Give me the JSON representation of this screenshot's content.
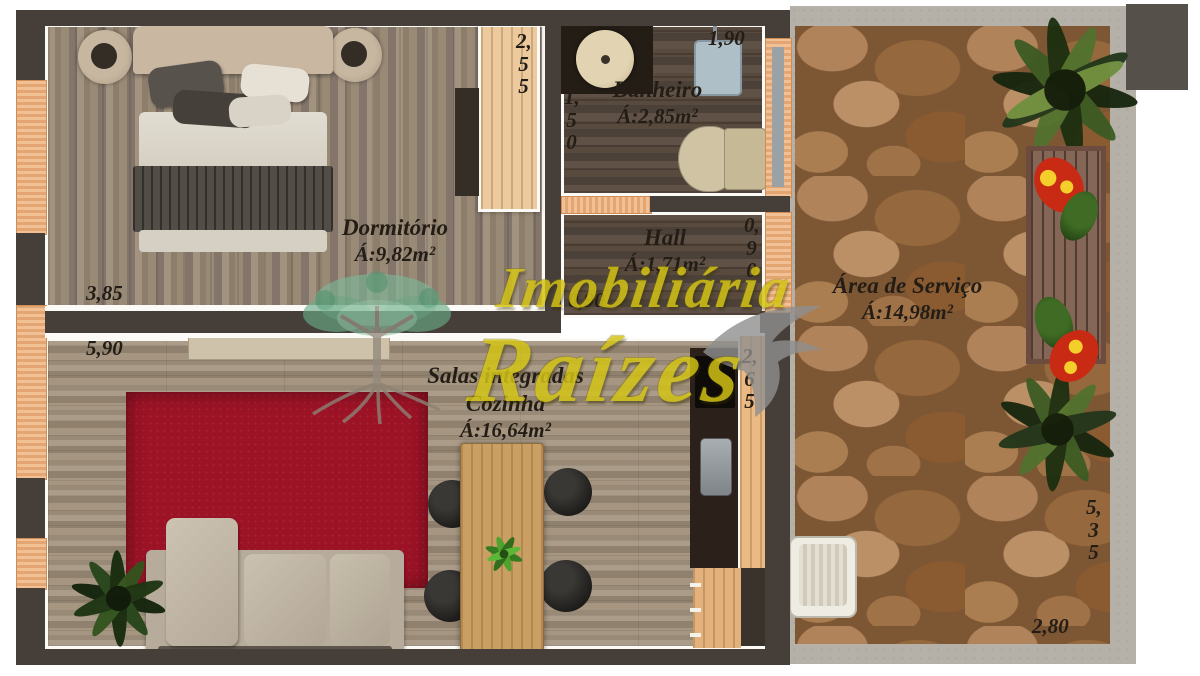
{
  "watermark": {
    "line1": "Imobiliária",
    "line2": "Raízes"
  },
  "rooms": {
    "dormitorio": {
      "name": "Dormitório",
      "area": "Á:9,82m²"
    },
    "banheiro": {
      "name": "Banheiro",
      "area": "Á:2,85m²"
    },
    "hall": {
      "name": "Hall",
      "area": "Á:1,71m²"
    },
    "sala": {
      "line1": "Salas integradas",
      "line2": "Cozinha",
      "area": "Á:16,64m²"
    },
    "servico": {
      "name": "Área de Serviço",
      "area": "Á:14,98m²"
    }
  },
  "dimensions": {
    "dorm_w": "3,85",
    "dorm_h": "2,55",
    "banheiro_w": "1,90",
    "banheiro_h": "1,50",
    "hall_h": "0,90",
    "hall_w": "0,90",
    "sala_w": "5,90",
    "cozinha_h": "2,65",
    "servico_h": "5,35",
    "servico_w": "2,80"
  },
  "colors": {
    "wall_dark": "#463f39",
    "watermark_yellow": "#d4c414",
    "rug_red": "#9c1326",
    "stone_brown": "#9c7048"
  }
}
